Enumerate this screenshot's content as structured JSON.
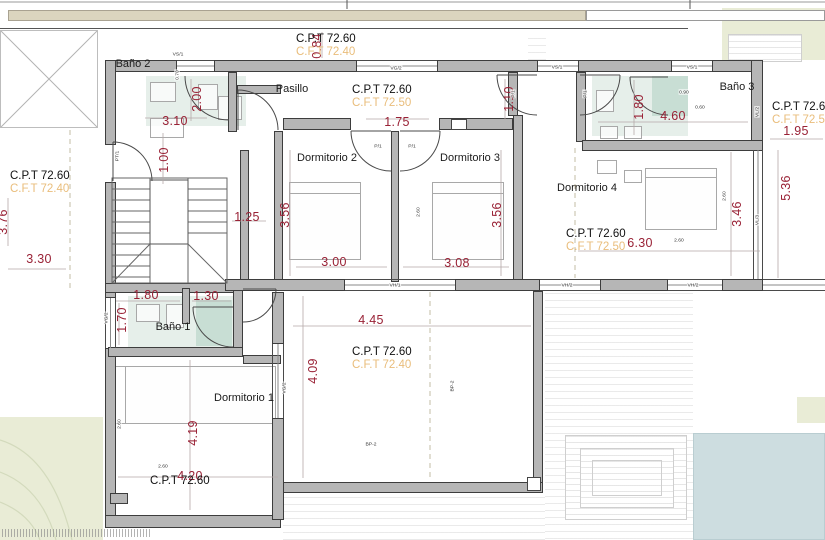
{
  "colors": {
    "wall": "#b6b6b6",
    "dimension_red": "#992135",
    "level_cpt": "#111111",
    "level_cft": "#e9bd7b",
    "pool": "#cddde0",
    "garden": "#e9ecd6",
    "top_strip": "#dbd5bf",
    "bath_tint": "#bcd6c7"
  },
  "rooms": [
    {
      "label": "Baño 2",
      "x": 133,
      "y": 64
    },
    {
      "label": "Pasillo",
      "x": 292,
      "y": 89
    },
    {
      "label": "Baño 3",
      "x": 737,
      "y": 87
    },
    {
      "label": "Dormitorio 2",
      "x": 327,
      "y": 158
    },
    {
      "label": "Dormitorio 3",
      "x": 470,
      "y": 158
    },
    {
      "label": "Dormitorio 4",
      "x": 587,
      "y": 188
    },
    {
      "label": "Baño 1",
      "x": 173,
      "y": 327
    },
    {
      "label": "Dormitorio 1",
      "x": 244,
      "y": 398
    }
  ],
  "levels": [
    {
      "cpt": "C.P.T 72.60",
      "cft": "C.F.T 72.40",
      "x": 296,
      "y": 33
    },
    {
      "cpt": "C.P.T 72.60",
      "cft": "C.F.T 72.50",
      "x": 352,
      "y": 84
    },
    {
      "cpt": "C.P.T 72.60",
      "cft": "C.F.T 72.40",
      "x": 10,
      "y": 170
    },
    {
      "cpt": "C.P.T 72.60",
      "cft": "C.F.T 72.50",
      "x": 772,
      "y": 101
    },
    {
      "cpt": "C.P.T 72.60",
      "cft": "C.F.T 72.50",
      "x": 566,
      "y": 228
    },
    {
      "cpt": "C.P.T 72.60",
      "cft": "C.F.T 72.40",
      "x": 352,
      "y": 346
    },
    {
      "cpt": "C.P.T 72.60",
      "cft": "",
      "x": 150,
      "y": 475
    }
  ],
  "dims": [
    {
      "text": "0.84",
      "x": 317,
      "y": 46,
      "v": true
    },
    {
      "text": "3.10",
      "x": 175,
      "y": 121
    },
    {
      "text": "2.00",
      "x": 197,
      "y": 99,
      "v": true
    },
    {
      "text": "1.00",
      "x": 164,
      "y": 160,
      "v": true
    },
    {
      "text": "1.25",
      "x": 247,
      "y": 217
    },
    {
      "text": "3.30",
      "x": 39,
      "y": 259
    },
    {
      "text": "3.76",
      "x": 3,
      "y": 222,
      "v": true
    },
    {
      "text": "1.75",
      "x": 397,
      "y": 122
    },
    {
      "text": "1.10",
      "x": 509,
      "y": 99,
      "v": true
    },
    {
      "text": "3.56",
      "x": 285,
      "y": 215,
      "v": true
    },
    {
      "text": "3.56",
      "x": 497,
      "y": 215,
      "v": true
    },
    {
      "text": "3.00",
      "x": 334,
      "y": 262
    },
    {
      "text": "3.08",
      "x": 457,
      "y": 263
    },
    {
      "text": "1.80",
      "x": 639,
      "y": 107,
      "v": true
    },
    {
      "text": "4.60",
      "x": 673,
      "y": 116
    },
    {
      "text": "1.95",
      "x": 796,
      "y": 131
    },
    {
      "text": "5.36",
      "x": 786,
      "y": 188,
      "v": true
    },
    {
      "text": "3.46",
      "x": 737,
      "y": 214,
      "v": true
    },
    {
      "text": "6.30",
      "x": 640,
      "y": 243
    },
    {
      "text": "1.80",
      "x": 146,
      "y": 295
    },
    {
      "text": "1.30",
      "x": 206,
      "y": 296
    },
    {
      "text": "1.70",
      "x": 122,
      "y": 320,
      "v": true
    },
    {
      "text": "4.45",
      "x": 371,
      "y": 320
    },
    {
      "text": "4.09",
      "x": 313,
      "y": 371,
      "v": true
    },
    {
      "text": "4.19",
      "x": 193,
      "y": 433,
      "v": true
    },
    {
      "text": "4.20",
      "x": 190,
      "y": 476
    }
  ],
  "tags": [
    {
      "text": "VS/1",
      "x": 178,
      "y": 54
    },
    {
      "text": "VS/1",
      "x": 557,
      "y": 67
    },
    {
      "text": "VS/1",
      "x": 692,
      "y": 67
    },
    {
      "text": "VG/2",
      "x": 396,
      "y": 68
    },
    {
      "text": "VH/1",
      "x": 395,
      "y": 285
    },
    {
      "text": "VH/2",
      "x": 567,
      "y": 285
    },
    {
      "text": "VH/2",
      "x": 693,
      "y": 285
    },
    {
      "text": "VG/2",
      "x": 106,
      "y": 318,
      "v": true
    },
    {
      "text": "VG/2",
      "x": 284,
      "y": 388,
      "v": true
    },
    {
      "text": "VL/2",
      "x": 757,
      "y": 112,
      "v": true
    },
    {
      "text": "VL/3",
      "x": 757,
      "y": 220,
      "v": true
    },
    {
      "text": "PT/1",
      "x": 117,
      "y": 156,
      "v": true
    },
    {
      "text": "P/1",
      "x": 378,
      "y": 146
    },
    {
      "text": "P/1",
      "x": 412,
      "y": 146
    },
    {
      "text": "P/1",
      "x": 513,
      "y": 94,
      "v": true
    },
    {
      "text": "P/1",
      "x": 585,
      "y": 94,
      "v": true
    },
    {
      "text": "BP-2",
      "x": 371,
      "y": 444
    },
    {
      "text": "BP-2",
      "x": 452,
      "y": 386,
      "v": true
    },
    {
      "text": "2.60",
      "x": 163,
      "y": 466
    },
    {
      "text": "2.60",
      "x": 119,
      "y": 424,
      "v": true
    },
    {
      "text": "2.60",
      "x": 679,
      "y": 240
    },
    {
      "text": "2.60",
      "x": 724,
      "y": 196,
      "v": true
    },
    {
      "text": "2.60",
      "x": 418,
      "y": 212,
      "v": true
    },
    {
      "text": "0.90",
      "x": 684,
      "y": 92
    },
    {
      "text": "0.60",
      "x": 700,
      "y": 107
    },
    {
      "text": "0.70",
      "x": 177,
      "y": 75,
      "v": true
    }
  ]
}
